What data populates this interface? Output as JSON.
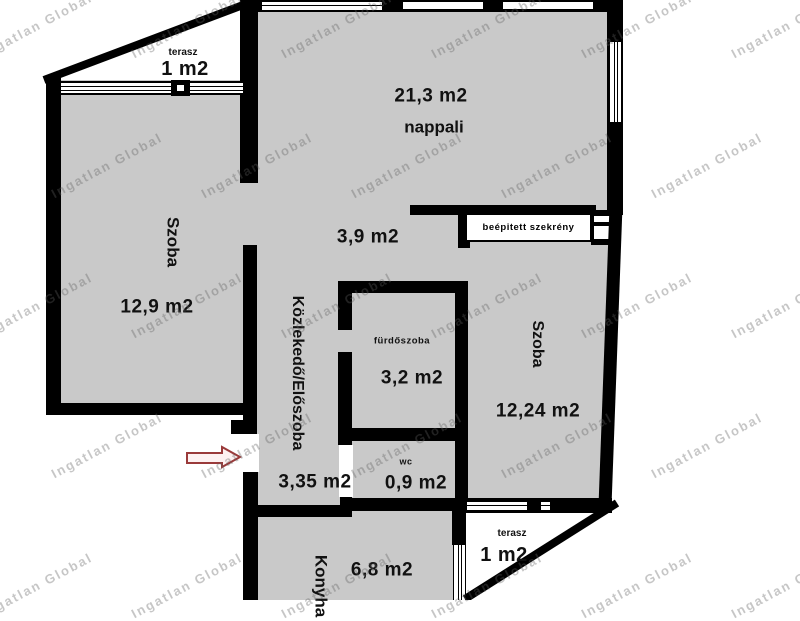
{
  "watermark": {
    "text": "Ingatlan Global"
  },
  "rooms": {
    "terasz_top": {
      "label": "terasz",
      "area": "1 m2"
    },
    "nappali": {
      "label": "nappali",
      "area": "21,3 m2"
    },
    "szoba_left": {
      "label": "Szoba",
      "area": "12,9 m2"
    },
    "corridor": {
      "area": "3,9 m2"
    },
    "szekreny": {
      "label": "beépitett szekrény"
    },
    "kozlekedo": {
      "label": "Közlekedő/Előszoba",
      "area": "3,35 m2"
    },
    "furdoszoba": {
      "label": "fürdőszoba",
      "area": "3,2 m2"
    },
    "szoba_right": {
      "label": "Szoba",
      "area": "12,24 m2"
    },
    "wc": {
      "label": "wc",
      "area": "0,9 m2"
    },
    "konyha": {
      "label": "Konyha",
      "area": "6,8 m2"
    },
    "terasz_bottom": {
      "label": "terasz",
      "area": "1 m2"
    }
  },
  "colors": {
    "wall": "#000000",
    "room_fill": "#c9c9c9",
    "background": "#ffffff",
    "arrow_outline": "#9a3a3a",
    "watermark_gray": "#5f5f5f"
  }
}
